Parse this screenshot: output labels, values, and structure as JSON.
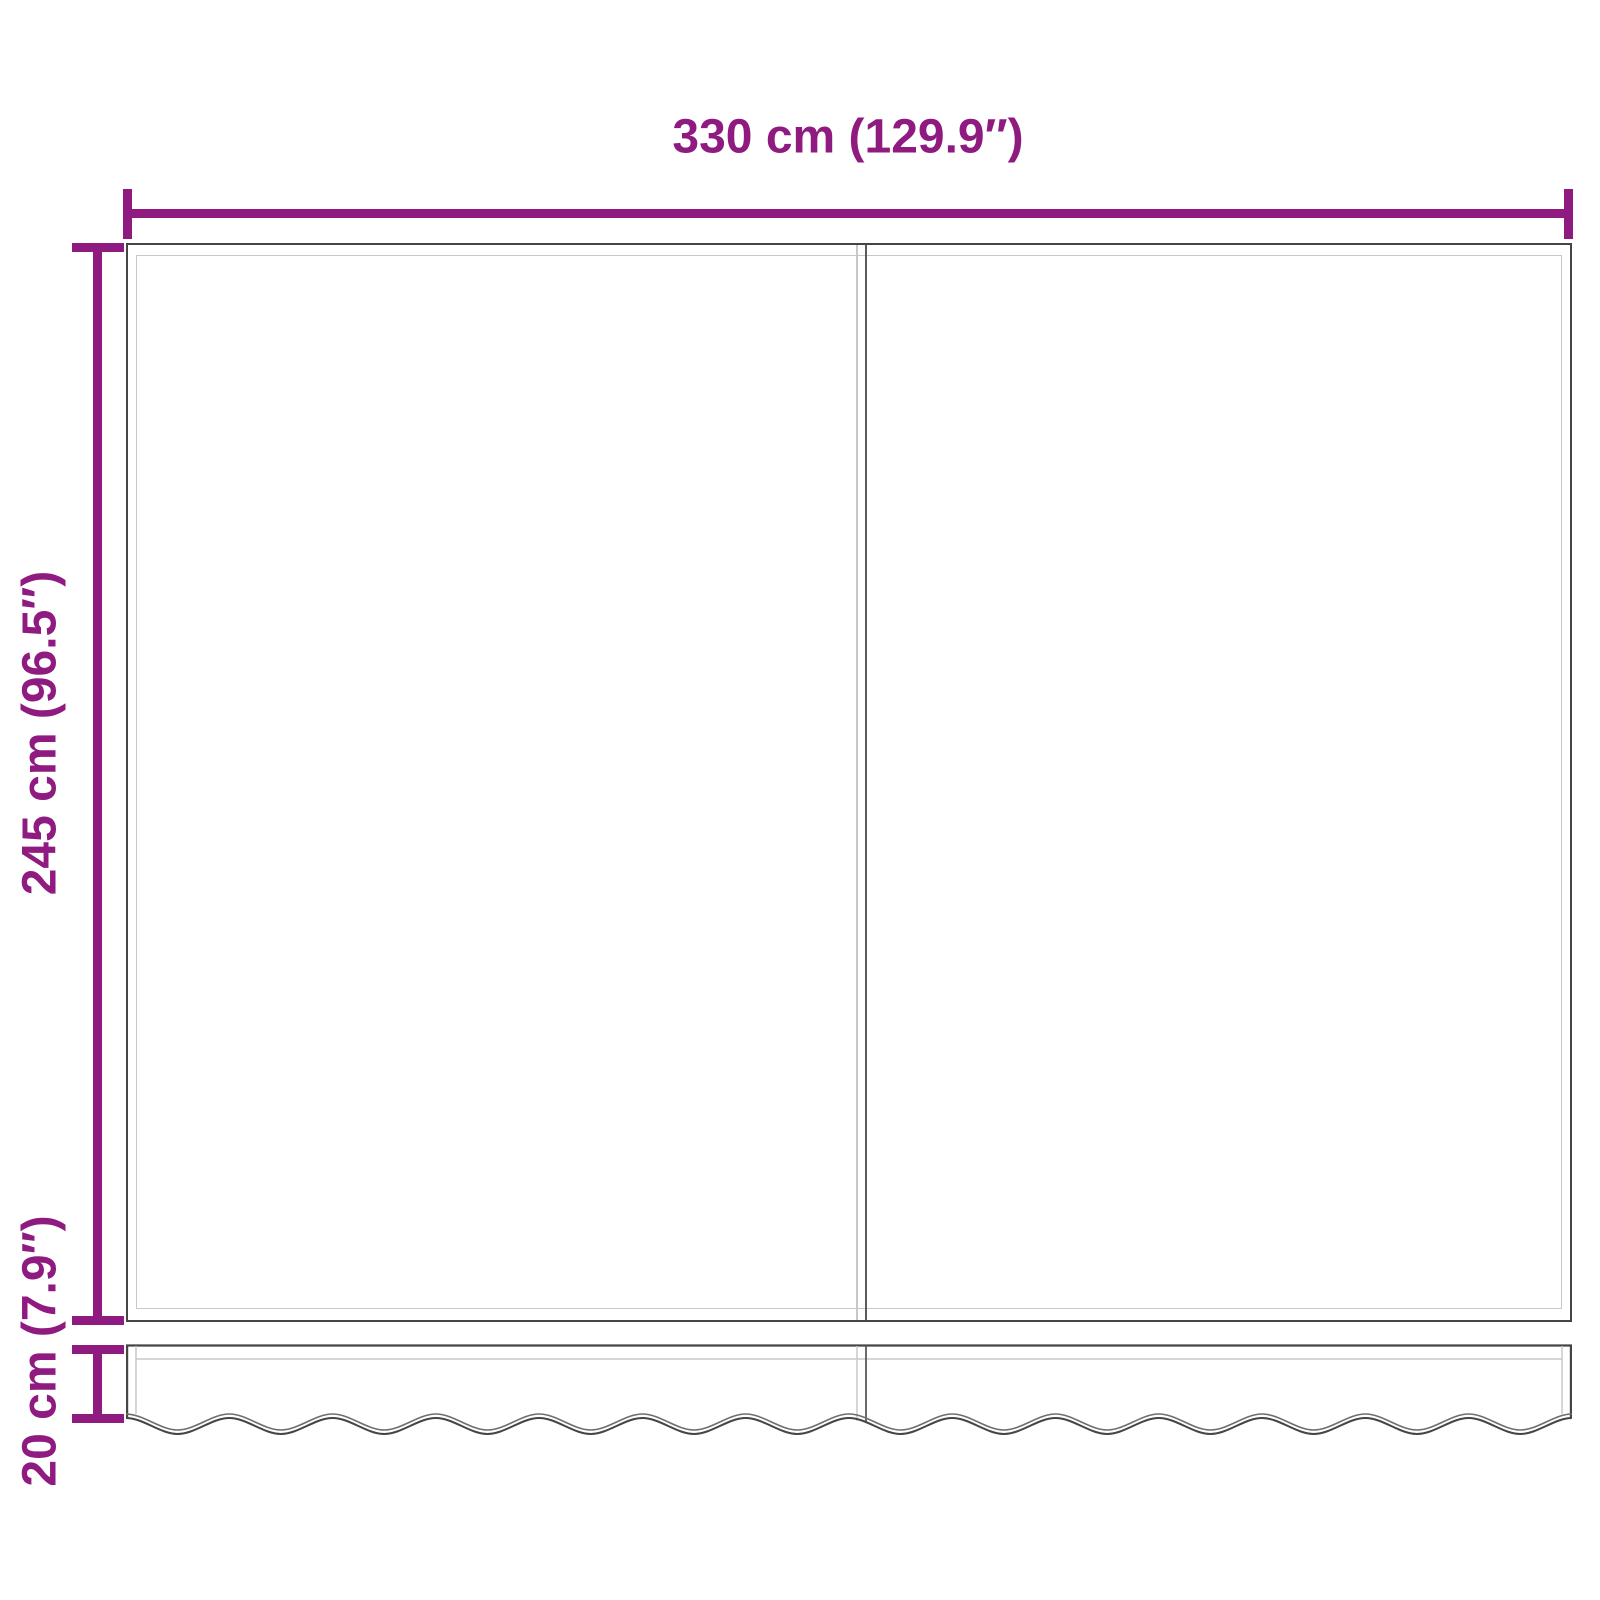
{
  "diagram": {
    "title": "awning-fabric-dimension-diagram",
    "width_dimension": {
      "label": "330 cm (129.9″)"
    },
    "height_dimension": {
      "label": "245 cm (96.5″)"
    },
    "valance_dimension": {
      "label": "20 cm (7.9″)"
    }
  },
  "colors": {
    "dimension": "#8F1B80",
    "outline_dark": "#454545",
    "outline_mid": "#5a5a5a",
    "outline_light": "#c8c8c8",
    "background": "#ffffff"
  },
  "drawing": {
    "wave": {
      "halves": 28,
      "amplitude": 16,
      "width": 1446,
      "crest_y": 74,
      "ribbon_offset": 4
    }
  }
}
